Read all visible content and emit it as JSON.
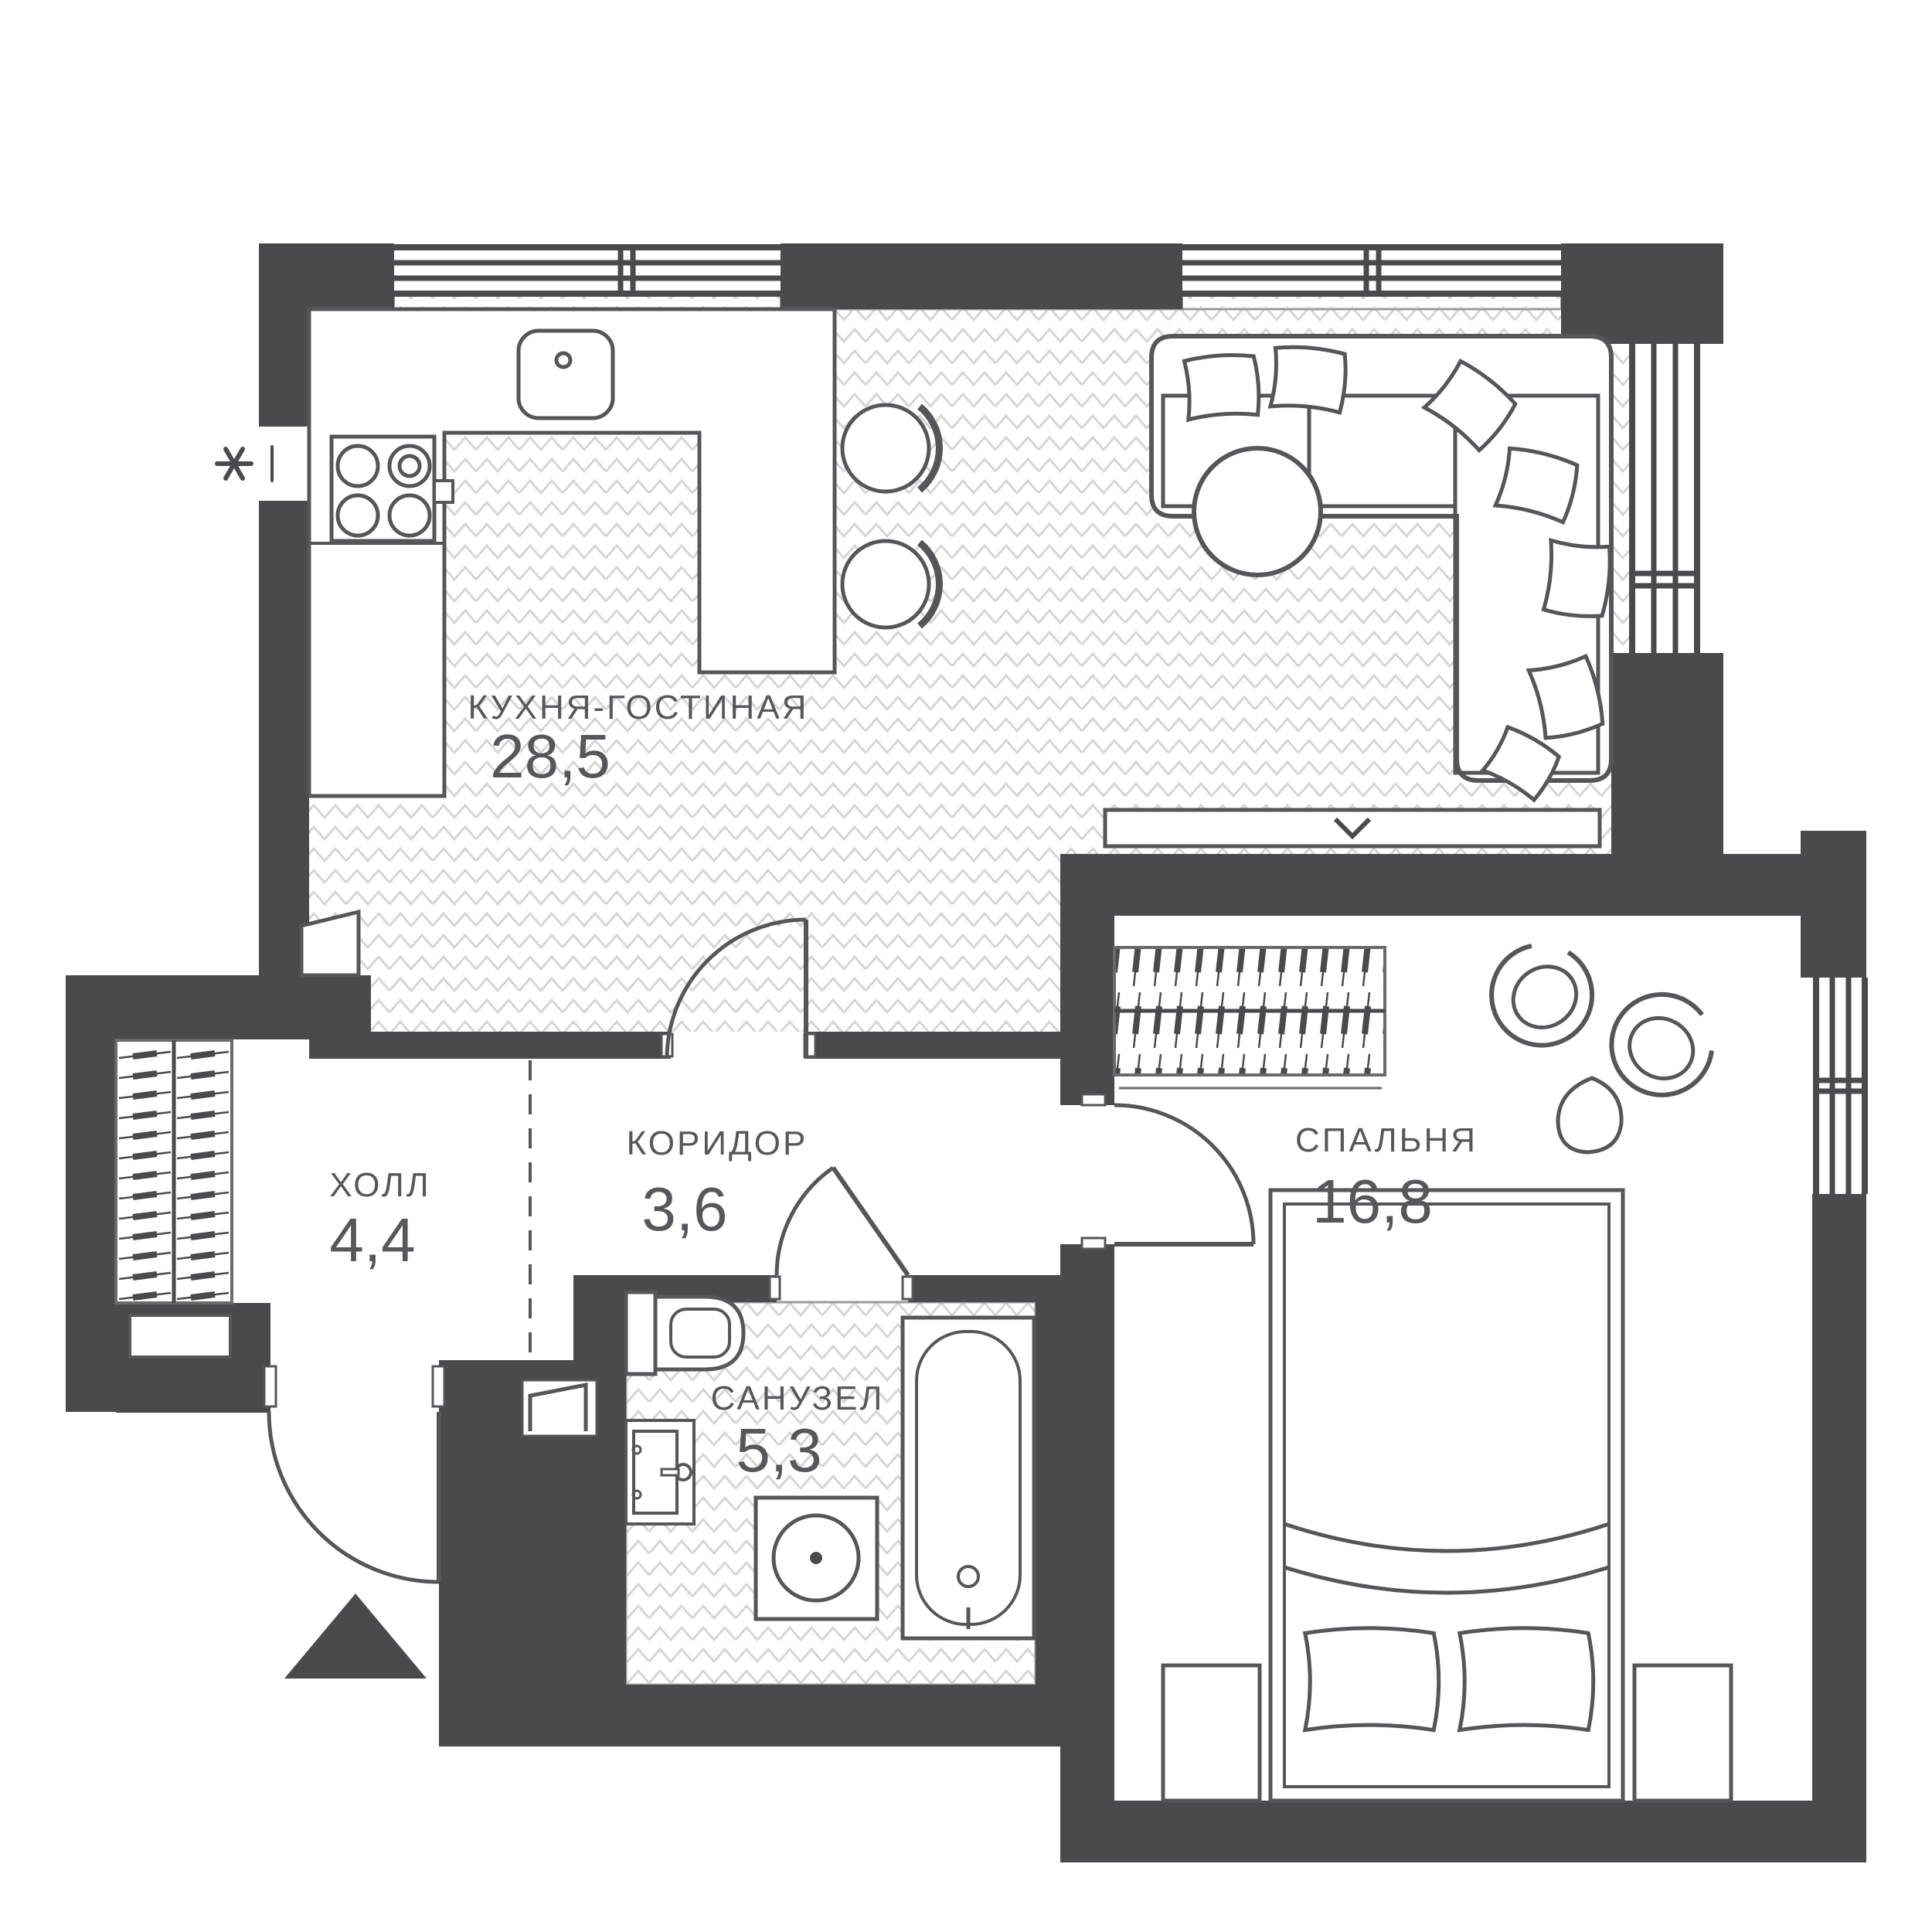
{
  "plan": {
    "type": "apartment-floor-plan",
    "rooms": [
      {
        "id": "kitchen-living",
        "name": "КУХНЯ-ГОСТИНАЯ",
        "area": "28,5"
      },
      {
        "id": "corridor",
        "name": "КОРИДОР",
        "area": "3,6"
      },
      {
        "id": "hall",
        "name": "ХОЛЛ",
        "area": "4,4"
      },
      {
        "id": "bathroom",
        "name": "САНУЗЕЛ",
        "area": "5,3"
      },
      {
        "id": "bedroom",
        "name": "СПАЛЬНЯ",
        "area": "16,8"
      }
    ],
    "colors": {
      "wall": "#4a4a4d",
      "outline": "#55555a",
      "floor_chevron": "#d5d5d5",
      "label": "#57575b",
      "background": "#ffffff"
    },
    "symbols": [
      "window",
      "door-swing",
      "entrance-arrow",
      "wardrobe-hangers",
      "kitchen-sink",
      "stove",
      "bar-chair",
      "sofa",
      "pillow",
      "coffee-table",
      "tv-console",
      "bed",
      "nightstand",
      "armchair",
      "side-table",
      "toilet",
      "washbasin",
      "washing-machine",
      "bathtub",
      "ventilation-asterisk",
      "mirror-panel"
    ]
  }
}
